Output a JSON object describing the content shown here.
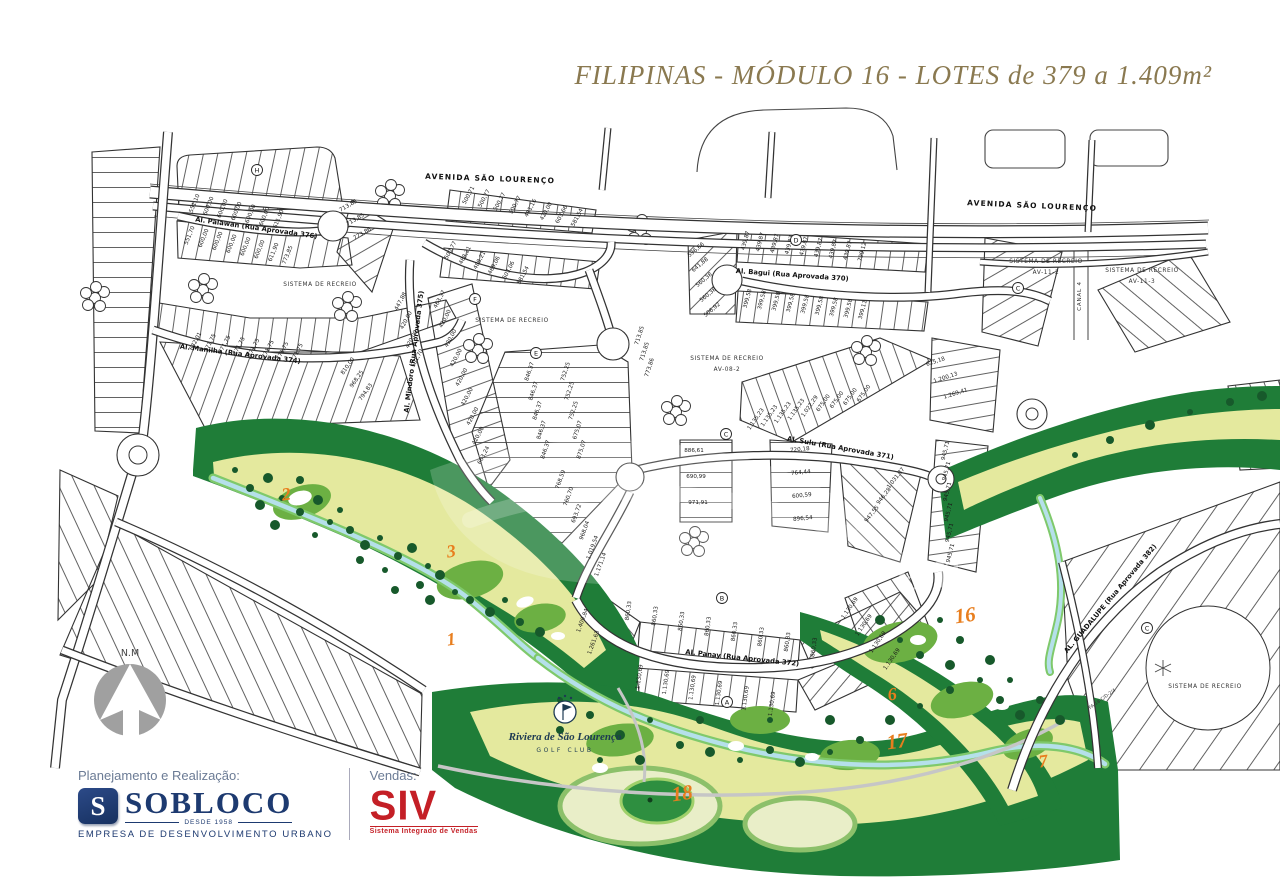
{
  "title": "FILIPINAS - MÓDULO 16 - LOTES de 379 a 1.409m²",
  "colors": {
    "title_text": "#8a7950",
    "navy": "#1d3a70",
    "red": "#c41f26",
    "golf_dark": "#1f7d38",
    "golf_light": "#e4e99e",
    "golf_mid": "#6cb043",
    "stream": "#b5e0ea",
    "hole_number": "#e87e1e"
  },
  "map": {
    "avenue": "AVENIDA SÃO LOURENÇO",
    "streets": [
      "Al. Palawan  (Rua Aprovada 376)",
      "Al. Manilha  (Rua Aprovada 374)",
      "Al. Mindoro  (Rua Aprovada 375)",
      "Al. Bagui  (Rua Aprovada 370)",
      "Al. Sulu  (Rua Aprovada 371)",
      "Al. Panay  (Rua Aprovada 372)",
      "AL. GUADALUPE  (Rua Aprovada 382)"
    ],
    "canal": "CANAL 4",
    "area_code": "FA-18-C/D-2/4",
    "compass": "N.M",
    "watermark": "em",
    "recreation": {
      "title": "SISTEMA DE RECREIO",
      "codes": [
        "AV-08-2",
        "AV-11-2",
        "AV-11-3"
      ]
    },
    "golf_club": {
      "name": "Riviera de São Lourenço",
      "subtitle": "GOLF CLUB"
    },
    "golf_holes": [
      "2",
      "3",
      "1",
      "6",
      "16",
      "17",
      "18",
      "7"
    ],
    "block_letters": [
      "H",
      "F",
      "E",
      "D",
      "C",
      "B",
      "A",
      "C",
      "C"
    ],
    "lot_groups": {
      "palawan_n": [
        "551,10",
        "600,00",
        "600,00",
        "600,00",
        "600,00",
        "600,00",
        "611,90"
      ],
      "palawan_s": [
        "551,70",
        "600,00",
        "600,00",
        "600,00",
        "600,00",
        "600,00",
        "611,90",
        "773,85"
      ],
      "palawan_e": [
        "713,85",
        "713,85",
        "773,86"
      ],
      "manilha_n": [
        "632,01",
        "771,75",
        "771,75",
        "771,75",
        "771,75",
        "771,75",
        "771,75",
        "771,75"
      ],
      "manilha_e": [
        "810,00",
        "968,25",
        "794,83"
      ],
      "mindoro_w": [
        "447,88",
        "420,00",
        "420,00",
        "501,70"
      ],
      "mindoro_e": [
        "463,37",
        "420,00",
        "420,00",
        "420,00",
        "420,00",
        "420,00",
        "420,00",
        "420,00",
        "663,24"
      ],
      "serp_top": [
        "500,71",
        "500,77",
        "500,77",
        "500,77",
        "481,16",
        "420,00",
        "603,66",
        "581,54"
      ],
      "serp_mid": [
        "500,77",
        "488,21",
        "488,21",
        "469,06",
        "603,06",
        "581,54"
      ],
      "center_bulb": [
        "713,85",
        "713,85",
        "773,86"
      ],
      "center_w": [
        "846,37",
        "846,37",
        "846,37",
        "846,37",
        "846,37"
      ],
      "center_e": [
        "752,25",
        "752,25",
        "752,25",
        "675,07",
        "875,07"
      ],
      "center_s": [
        "768,59",
        "760,70",
        "693,72",
        "968,04",
        "1.019,54",
        "1.171,14"
      ],
      "bagui_w": [
        "596,66",
        "641,88",
        "560,38",
        "560,38",
        "506,92"
      ],
      "bagui_n": [
        "439,87",
        "439,87",
        "439,87",
        "439,87",
        "439,87",
        "439,87",
        "439,87",
        "439,87",
        "799,12"
      ],
      "bagui_s": [
        "399,58",
        "399,58",
        "399,58",
        "399,58",
        "399,58",
        "399,58",
        "399,58",
        "399,58",
        "399,11"
      ],
      "right_serp": [
        "1.135,23",
        "1.135,23",
        "1.135,23",
        "1.135,23",
        "1.022,29",
        "675,00",
        "675,00",
        "675,00",
        "675,00"
      ],
      "right_e": [
        "625,18",
        "1.200,13",
        "1.269,41"
      ],
      "sulu_w": [
        "886,61",
        "690,99",
        "971,91"
      ],
      "sulu_m": [
        "720,18",
        "764,44",
        "600,59",
        "896,54"
      ],
      "sulu_e": [
        "1.031,37",
        "946,28",
        "947,55"
      ],
      "panay_nw": [
        "1.409,84",
        "1.261,63"
      ],
      "panay_n": [
        "860,33",
        "860,33",
        "860,33",
        "860,33",
        "860,33",
        "860,33",
        "860,33",
        "860,33"
      ],
      "panay_s": [
        "1.130,69",
        "1.130,69",
        "1.130,69",
        "1.130,69",
        "1.130,69",
        "1.130,69"
      ],
      "panay_se": [
        "1.130,69",
        "1.130,69",
        "1.130,69",
        "1.130,69"
      ],
      "right_col": [
        "945,71",
        "945,71",
        "945,71",
        "945,71",
        "945,71",
        "945,71"
      ]
    }
  },
  "footer": {
    "planning_label": "Planejamento e Realização:",
    "sobloco": {
      "initial": "S",
      "name": "SOBLOCO",
      "since": "DESDE 1958",
      "tagline": "EMPRESA DE DESENVOLVIMENTO URBANO"
    },
    "sales_label": "Vendas:",
    "siv": {
      "name": "SIV",
      "tagline": "Sistema Integrado de Vendas"
    }
  }
}
